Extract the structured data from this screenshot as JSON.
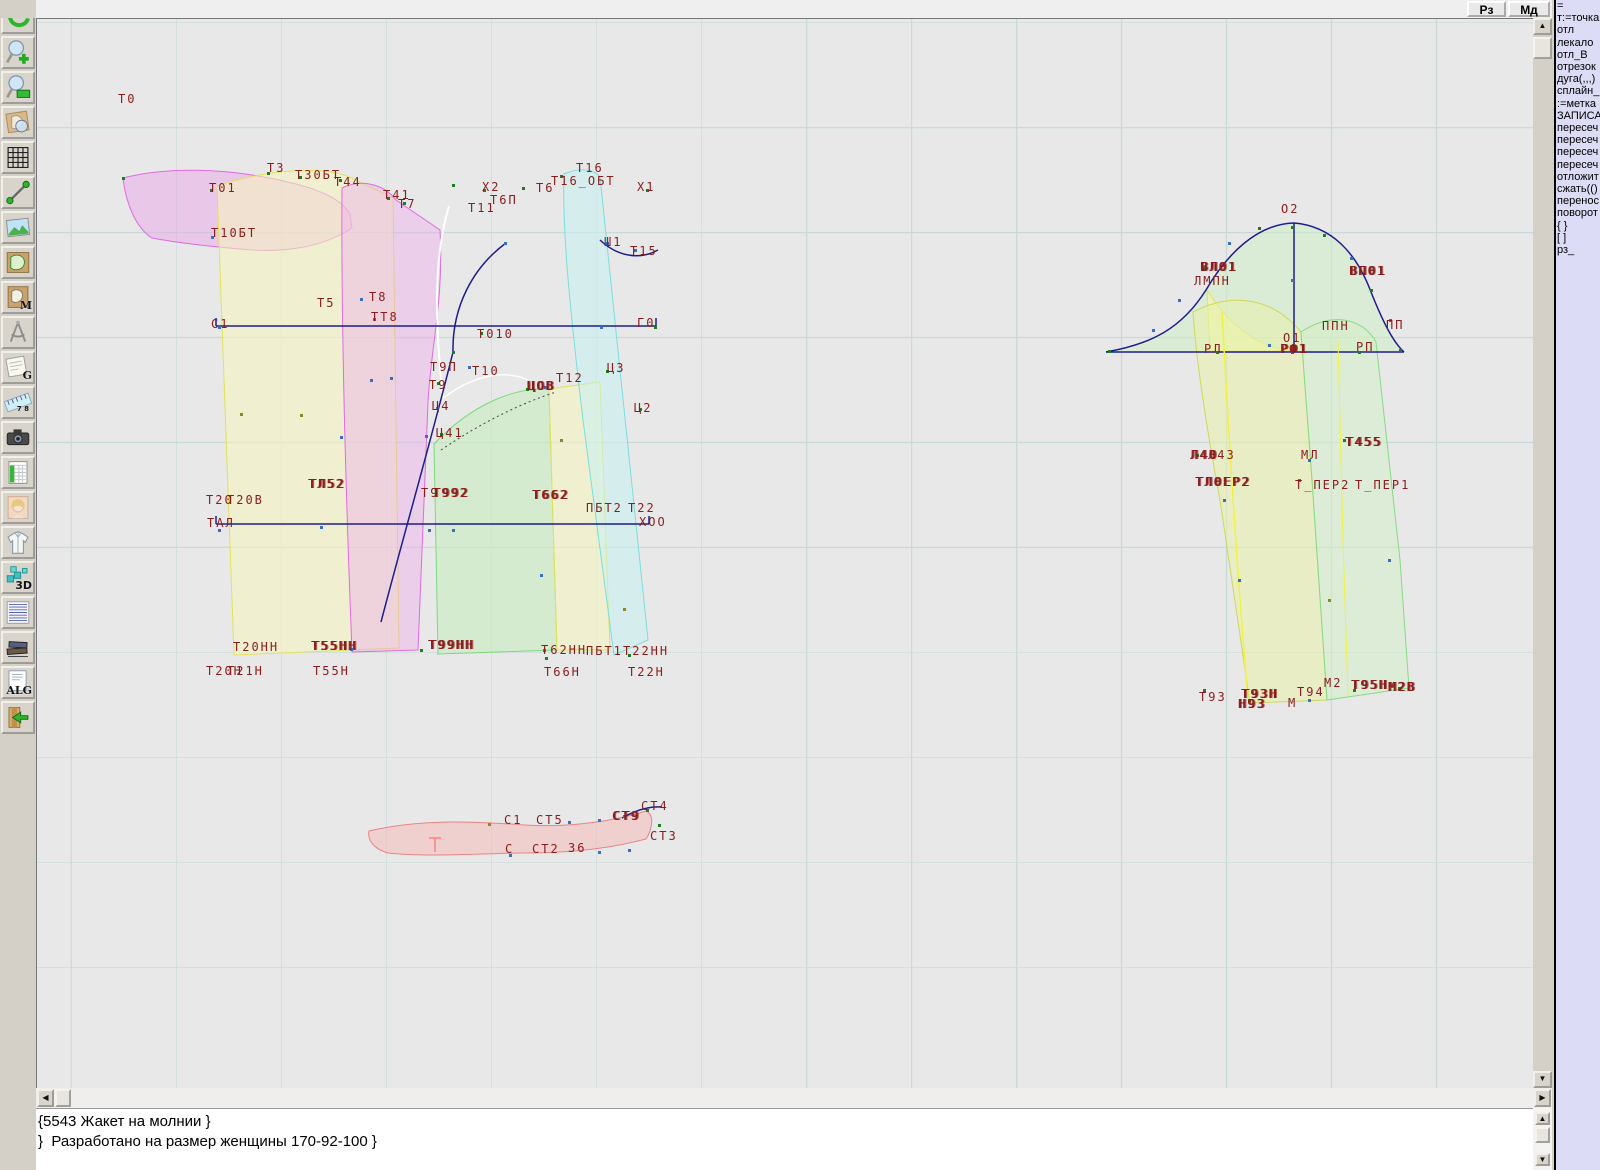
{
  "topbar": {
    "rz_label": "Рз",
    "md_label": "Мд"
  },
  "toolbar": {
    "buttons": [
      {
        "icon": "undo-arrow"
      },
      {
        "icon": "zoom-in"
      },
      {
        "icon": "zoom-window"
      },
      {
        "icon": "view-piece"
      },
      {
        "icon": "grid"
      },
      {
        "icon": "segment"
      },
      {
        "icon": "image"
      },
      {
        "icon": "pattern-piece"
      },
      {
        "icon": "pattern-m",
        "text": "M"
      },
      {
        "icon": "compasses"
      },
      {
        "icon": "grazia-g",
        "text": "G"
      },
      {
        "icon": "ruler",
        "text": "7 8"
      },
      {
        "icon": "camera"
      },
      {
        "icon": "spreadsheet"
      },
      {
        "icon": "portrait"
      },
      {
        "icon": "jacket"
      },
      {
        "icon": "threed",
        "text": "3D"
      },
      {
        "icon": "text-list"
      },
      {
        "icon": "books"
      },
      {
        "icon": "alg",
        "text": "ALG"
      },
      {
        "icon": "exit"
      }
    ]
  },
  "panel": {
    "lines": [
      "=",
      "т:=точка",
      "отл",
      "лекало",
      "отл_В",
      "отрезок",
      "дуга(,,,)",
      "сплайн_",
      ":=метка",
      "ЗАПИСА",
      "пересеч",
      "пересеч",
      "пересеч",
      "пересеч",
      "отложит",
      "сжать(()",
      "перенос",
      "поворот",
      "{ }",
      "[ ]",
      "рз_"
    ]
  },
  "console": {
    "lines": [
      "{5543 Жакет на молнии }",
      "}  Разработано на размер женщины 170-92-100 }"
    ]
  },
  "canvas": {
    "colors": {
      "label": "#8b1c1c",
      "navy": "#1d1d8f",
      "grid": "#c7dad8",
      "bg": "#e8e8e8"
    },
    "labels": [
      [
        118,
        92,
        "Т0"
      ],
      [
        267,
        161,
        "Т3"
      ],
      [
        295,
        168,
        "Т30БТ"
      ],
      [
        334,
        175,
        "Т44"
      ],
      [
        383,
        188,
        "Т41"
      ],
      [
        398,
        197,
        "Т7"
      ],
      [
        209,
        181,
        "Т01"
      ],
      [
        211,
        226,
        "Т10БТ"
      ],
      [
        482,
        180,
        "Х2"
      ],
      [
        490,
        193,
        "Т6П"
      ],
      [
        468,
        201,
        "Т11"
      ],
      [
        536,
        181,
        "Т6"
      ],
      [
        576,
        161,
        "Т16"
      ],
      [
        551,
        174,
        "Т16_ОБТ"
      ],
      [
        637,
        180,
        "Х1"
      ],
      [
        604,
        235,
        "Ш1"
      ],
      [
        630,
        244,
        "Т15"
      ],
      [
        317,
        296,
        "Т5"
      ],
      [
        369,
        290,
        "Т8"
      ],
      [
        371,
        310,
        "ТТ8"
      ],
      [
        211,
        317,
        "С1"
      ],
      [
        637,
        316,
        "Г0"
      ],
      [
        477,
        327,
        "Т010"
      ],
      [
        430,
        360,
        "Т9П"
      ],
      [
        472,
        364,
        "Т10"
      ],
      [
        429,
        378,
        "Т9"
      ],
      [
        432,
        399,
        "Ц4"
      ],
      [
        436,
        426,
        "Ц41"
      ],
      [
        556,
        371,
        "Т12"
      ],
      [
        527,
        379,
        "ЦОВ",
        1
      ],
      [
        607,
        361,
        "Ц3"
      ],
      [
        634,
        401,
        "Ц2"
      ],
      [
        308,
        477,
        "ТЛ52",
        1
      ],
      [
        206,
        493,
        "Т20"
      ],
      [
        227,
        493,
        "Т20В"
      ],
      [
        207,
        516,
        "ТАЛ"
      ],
      [
        421,
        486,
        "Т9"
      ],
      [
        432,
        486,
        "Т992",
        1
      ],
      [
        532,
        488,
        "Т662",
        1
      ],
      [
        586,
        501,
        "ПБТ2"
      ],
      [
        628,
        501,
        "Т22"
      ],
      [
        639,
        515,
        "ХОО"
      ],
      [
        233,
        640,
        "Т20НН"
      ],
      [
        311,
        639,
        "Т55НН",
        1
      ],
      [
        428,
        638,
        "Т99НН",
        1
      ],
      [
        541,
        643,
        "Т62НН"
      ],
      [
        586,
        644,
        "ПБТ1"
      ],
      [
        623,
        644,
        "Т22НН"
      ],
      [
        206,
        664,
        "Т20Н"
      ],
      [
        227,
        664,
        "Т21Н"
      ],
      [
        313,
        664,
        "Т55Н"
      ],
      [
        544,
        665,
        "Т66Н"
      ],
      [
        628,
        665,
        "Т22Н"
      ],
      [
        504,
        813,
        "С1"
      ],
      [
        536,
        813,
        "СТ5"
      ],
      [
        612,
        809,
        "СТ9",
        1
      ],
      [
        641,
        799,
        "СТ4"
      ],
      [
        650,
        829,
        "СТ3"
      ],
      [
        505,
        842,
        "С"
      ],
      [
        532,
        842,
        "СТ2"
      ],
      [
        568,
        841,
        "36"
      ],
      [
        1281,
        202,
        "О2"
      ],
      [
        1200,
        260,
        "ВЛ01",
        1
      ],
      [
        1194,
        274,
        "ЛМПН"
      ],
      [
        1349,
        264,
        "ВП01",
        1
      ],
      [
        1322,
        319,
        "ППН"
      ],
      [
        1386,
        318,
        "ПП"
      ],
      [
        1283,
        331,
        "О1"
      ],
      [
        1280,
        342,
        "РФ1",
        1
      ],
      [
        1204,
        342,
        "РЛ"
      ],
      [
        1356,
        340,
        "РП"
      ],
      [
        1345,
        435,
        "Т455",
        1
      ],
      [
        1190,
        448,
        "Л40",
        1
      ],
      [
        1208,
        448,
        "Л43"
      ],
      [
        1301,
        448,
        "МЛ"
      ],
      [
        1195,
        475,
        "ТЛ0ЕР2",
        1
      ],
      [
        1295,
        478,
        "Т_ПЕР2"
      ],
      [
        1355,
        478,
        "Т_ПЕР1"
      ],
      [
        1199,
        690,
        "Т93"
      ],
      [
        1241,
        687,
        "Т93Н",
        1
      ],
      [
        1238,
        697,
        "Н93",
        1
      ],
      [
        1297,
        685,
        "Т94"
      ],
      [
        1288,
        696,
        "М"
      ],
      [
        1324,
        676,
        "М2"
      ],
      [
        1351,
        678,
        "Т95Н",
        1
      ],
      [
        1388,
        680,
        "М2В",
        1
      ]
    ],
    "points": [
      [
        122,
        177,
        "g"
      ],
      [
        210,
        189,
        "g"
      ],
      [
        267,
        172,
        "g"
      ],
      [
        299,
        176,
        "g"
      ],
      [
        339,
        179,
        "g"
      ],
      [
        387,
        197,
        "g"
      ],
      [
        403,
        202,
        "g"
      ],
      [
        211,
        236,
        "b"
      ],
      [
        452,
        184,
        "g"
      ],
      [
        483,
        189,
        "g"
      ],
      [
        522,
        187,
        "g"
      ],
      [
        560,
        175,
        "g"
      ],
      [
        646,
        189,
        "g"
      ],
      [
        606,
        242,
        "b"
      ],
      [
        634,
        249,
        "b"
      ],
      [
        504,
        242,
        "b"
      ],
      [
        360,
        298,
        "b"
      ],
      [
        373,
        318,
        "b"
      ],
      [
        218,
        326,
        "b"
      ],
      [
        480,
        332,
        "g"
      ],
      [
        600,
        326,
        "b"
      ],
      [
        654,
        326,
        "g"
      ],
      [
        452,
        351,
        "g"
      ],
      [
        468,
        366,
        "b"
      ],
      [
        437,
        382,
        "g"
      ],
      [
        436,
        407,
        "b"
      ],
      [
        440,
        433,
        "g"
      ],
      [
        526,
        388,
        "g"
      ],
      [
        544,
        386,
        "b"
      ],
      [
        606,
        370,
        "g"
      ],
      [
        639,
        408,
        "g"
      ],
      [
        370,
        379,
        "b"
      ],
      [
        390,
        377,
        "b"
      ],
      [
        425,
        435,
        "b"
      ],
      [
        560,
        439,
        "o"
      ],
      [
        340,
        436,
        "b"
      ],
      [
        300,
        414,
        "o"
      ],
      [
        240,
        413,
        "o"
      ],
      [
        218,
        529,
        "b"
      ],
      [
        320,
        526,
        "b"
      ],
      [
        428,
        529,
        "b"
      ],
      [
        452,
        529,
        "b"
      ],
      [
        540,
        574,
        "b"
      ],
      [
        350,
        648,
        "b"
      ],
      [
        420,
        649,
        "g"
      ],
      [
        543,
        649,
        "b"
      ],
      [
        628,
        654,
        "g"
      ],
      [
        545,
        657,
        "g"
      ],
      [
        623,
        608,
        "o"
      ],
      [
        488,
        823,
        "o"
      ],
      [
        568,
        821,
        "b"
      ],
      [
        598,
        819,
        "b"
      ],
      [
        623,
        815,
        "b"
      ],
      [
        646,
        809,
        "g"
      ],
      [
        658,
        824,
        "g"
      ],
      [
        509,
        854,
        "b"
      ],
      [
        598,
        851,
        "b"
      ],
      [
        628,
        849,
        "b"
      ],
      [
        1291,
        226,
        "g"
      ],
      [
        1258,
        227,
        "g"
      ],
      [
        1228,
        242,
        "b"
      ],
      [
        1203,
        267,
        "g"
      ],
      [
        1178,
        299,
        "b"
      ],
      [
        1152,
        329,
        "b"
      ],
      [
        1108,
        350,
        "g"
      ],
      [
        1323,
        234,
        "g"
      ],
      [
        1350,
        257,
        "b"
      ],
      [
        1370,
        289,
        "g"
      ],
      [
        1389,
        319,
        "b"
      ],
      [
        1399,
        349,
        "g"
      ],
      [
        1291,
        351,
        "g"
      ],
      [
        1268,
        344,
        "b"
      ],
      [
        1291,
        279,
        "b"
      ],
      [
        1216,
        351,
        "g"
      ],
      [
        1358,
        351,
        "g"
      ],
      [
        1196,
        454,
        "g"
      ],
      [
        1308,
        459,
        "b"
      ],
      [
        1343,
        439,
        "g"
      ],
      [
        1298,
        479,
        "b"
      ],
      [
        1203,
        689,
        "g"
      ],
      [
        1248,
        699,
        "g"
      ],
      [
        1308,
        699,
        "b"
      ],
      [
        1353,
        689,
        "g"
      ],
      [
        1398,
        687,
        "g"
      ],
      [
        1238,
        579,
        "b"
      ],
      [
        1223,
        499,
        "b"
      ],
      [
        1388,
        559,
        "b"
      ],
      [
        1328,
        599,
        "o"
      ]
    ],
    "shapes": [
      {
        "name": "collar-crescent",
        "d": "M123,178 C165,167 225,167 288,182 C322,190 342,200 350,214 L352,228 C322,248 284,252 252,250 C215,247 178,243 152,238 C136,228 126,204 123,178 Z",
        "fill": "rgba(236,160,236,0.45)",
        "stroke": "#e06ae0",
        "w": 1
      },
      {
        "name": "back-panel-yellow",
        "d": "M217,186 C262,171 316,165 347,176 L393,198 L399,648 L234,655 Z",
        "fill": "rgba(245,245,190,0.55)",
        "stroke": "#e2e258",
        "w": 1
      },
      {
        "name": "front-panel-pink",
        "d": "M342,188 C365,177 386,187 396,200 L440,230 C444,300 431,345 428,402 L418,650 L352,652 C346,500 341,330 342,188 Z",
        "fill": "rgba(238,168,238,0.4)",
        "stroke": "#e06ae0",
        "w": 1
      },
      {
        "name": "white-curve",
        "d": "M449,206 C432,262 436,332 443,398",
        "stroke": "#ffffff",
        "w": 2
      },
      {
        "name": "white-curve-2",
        "d": "M443,398 C470,378 500,368 528,380",
        "stroke": "#ffffff",
        "w": 1.5
      },
      {
        "name": "side-panel-green",
        "d": "M434,444 C472,404 515,387 549,389 L557,650 L438,654 Z",
        "fill": "rgba(198,236,192,0.6)",
        "stroke": "#7ed87e",
        "w": 1
      },
      {
        "name": "mid-panel-yellow",
        "d": "M549,389 L600,382 L610,650 L557,650 Z",
        "fill": "rgba(245,245,190,0.55)",
        "stroke": "#e2e258",
        "w": 1
      },
      {
        "name": "cyan-piece",
        "d": "M564,174 C580,167 594,169 600,177 L648,640 L614,655 L583,420 C570,310 562,230 564,174 Z",
        "fill": "rgba(198,240,240,0.55)",
        "stroke": "#7adede",
        "w": 1
      },
      {
        "name": "armhole-curve",
        "d": "M506,243 C472,268 452,308 453,352",
        "stroke": "#1d1d8f",
        "w": 1.5
      },
      {
        "name": "side-seam",
        "d": "M453,352 C434,430 405,530 381,622",
        "stroke": "#1d1d8f",
        "w": 1.5
      },
      {
        "name": "chest-line",
        "d": "M216,326 L656,326 M216,318 L216,326 M656,318 L656,326",
        "stroke": "#1d1d8f",
        "w": 1.5
      },
      {
        "name": "waist-line",
        "d": "M216,524 L649,524 M216,516 L216,524 M649,516 L649,524",
        "stroke": "#1d1d8f",
        "w": 1.5
      },
      {
        "name": "notch-curve",
        "d": "M600,240 C618,257 640,260 658,250",
        "stroke": "#1d1d8f",
        "w": 1.5
      },
      {
        "name": "dart-dashed",
        "d": "M441,450 C485,420 525,402 556,392",
        "stroke": "#444444",
        "w": 1,
        "dash": "2,3"
      },
      {
        "name": "sleeve-cap-fill",
        "d": "M1106,352 C1152,344 1182,328 1206,290 C1227,254 1257,224 1294,223 C1331,226 1356,252 1371,292 C1383,322 1393,342 1404,352 Z",
        "fill": "rgba(205,240,195,0.5)"
      },
      {
        "name": "sleeve-yellow-underlay",
        "d": "M1207,290 C1232,330 1262,348 1293,351 L1210,351 Z",
        "fill": "rgba(250,250,160,0.55)",
        "stroke": "#e2e258",
        "w": 1
      },
      {
        "name": "sleeve-lower-left-panel",
        "d": "M1193,312 C1232,292 1272,297 1301,332 L1312,480 L1327,700 L1250,703 L1220,500 C1207,430 1196,360 1193,312 Z",
        "fill": "rgba(232,240,170,0.55)",
        "stroke": "#cfd85a",
        "w": 1
      },
      {
        "name": "sleeve-lower-right-panel",
        "d": "M1301,332 C1331,312 1362,317 1376,342 L1400,560 L1409,688 L1327,700 L1312,480 Z",
        "fill": "rgba(212,238,198,0.55)",
        "stroke": "#84dc84",
        "w": 1
      },
      {
        "name": "sleeve-cap-outline",
        "d": "M1106,352 C1152,344 1182,328 1206,290 C1227,254 1257,224 1294,223 C1331,226 1356,252 1371,292 C1383,322 1393,342 1404,352",
        "stroke": "#1d1d8f",
        "w": 1.5
      },
      {
        "name": "sleeve-baseline",
        "d": "M1106,352 L1404,352",
        "stroke": "#1d1d8f",
        "w": 1.5
      },
      {
        "name": "sleeve-vertical",
        "d": "M1294,223 L1294,352",
        "stroke": "#1d1d8f",
        "w": 1.5
      },
      {
        "name": "sleeve-yellow-line-1",
        "d": "M1222,312 C1228,420 1236,560 1248,700",
        "stroke": "#f2f23c",
        "w": 1.5
      },
      {
        "name": "sleeve-yellow-line-2",
        "d": "M1338,340 C1340,450 1344,580 1348,695",
        "stroke": "#f2f23c",
        "w": 1
      },
      {
        "name": "collar-band",
        "d": "M369,831 C425,818 480,822 525,825 C572,828 618,820 646,811 C655,815 652,830 646,839 C600,851 558,853 520,853 C472,854 425,857 388,853 C374,849 367,840 369,831 Z",
        "fill": "rgba(246,186,186,0.55)",
        "stroke": "#e88484",
        "w": 1
      },
      {
        "name": "collar-navy-curve",
        "d": "M622,818 C636,810 650,806 662,807",
        "stroke": "#1d1d8f",
        "w": 1.5
      },
      {
        "name": "collar-pink-mark",
        "d": "M429,838 L441,838 M435,838 L435,852",
        "stroke": "#ff8080",
        "w": 1.5
      }
    ]
  }
}
